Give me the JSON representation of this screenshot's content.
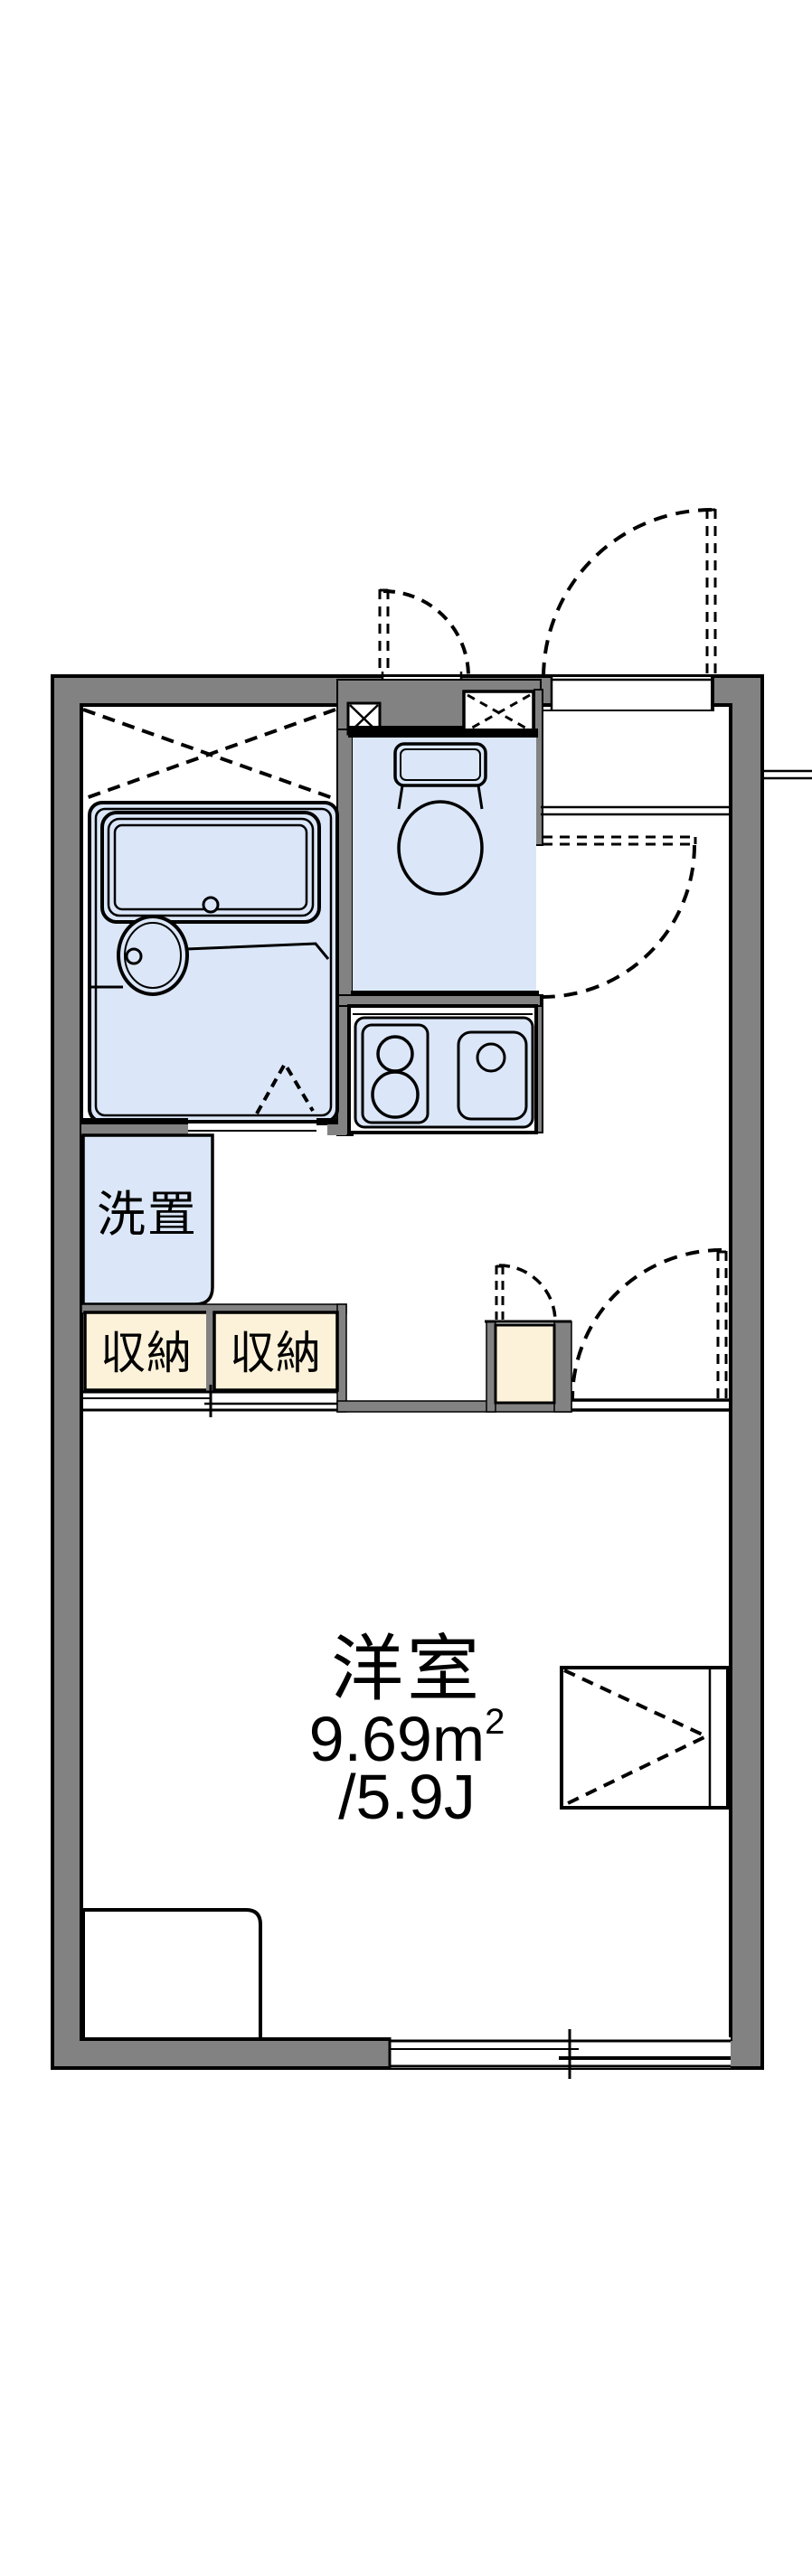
{
  "floorplan": {
    "type": "apartment-floor-plan",
    "labels": {
      "washer_space": "洗置",
      "storage_left": "収納",
      "storage_right": "収納",
      "room_name": "洋室",
      "room_area_m": "9.69m",
      "room_area_sup": "2",
      "room_area_jo": "/5.9J"
    },
    "features": [
      "bathtub",
      "washbasin",
      "toilet",
      "kitchen-stove-burners",
      "kitchen-sink",
      "entry-door-swing-arc",
      "toilet-door-swing-arc",
      "room-door-swing-arc",
      "cabinet-door-swing-arc",
      "service-door-swing-arc",
      "bath-folding-door",
      "pipe-space-x-box",
      "shoe-box-x-box",
      "storage-sliding-door",
      "balcony-sliding-window",
      "bed",
      "window-side-closet-chevron"
    ],
    "colors": {
      "wall_gray": "#828282",
      "fixture_blue": "#dbe7f8",
      "storage_cream": "#fcf2d9",
      "line_black": "#000000",
      "background": "#ffffff"
    }
  }
}
